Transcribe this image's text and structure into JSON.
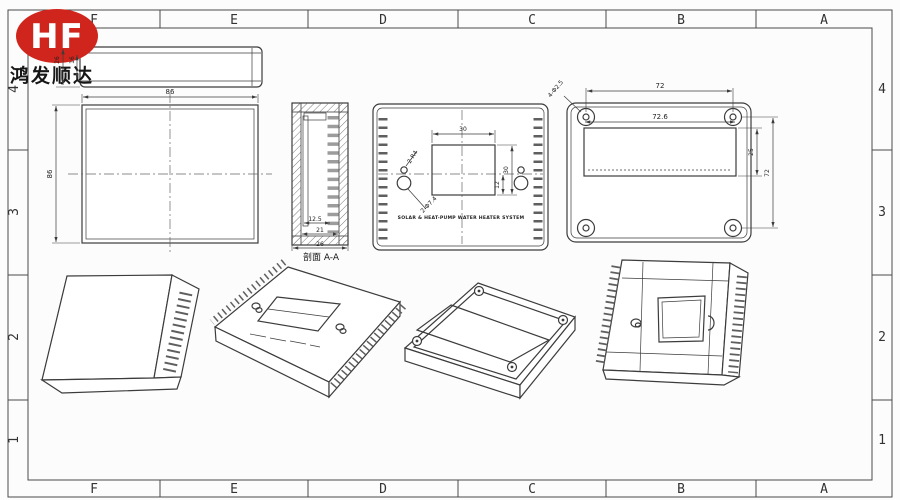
{
  "brand": {
    "logo_text": "HF",
    "company_name": "鸿发顺达"
  },
  "colors": {
    "logo_red": "#d0251c",
    "line": "#3c3c3c"
  },
  "sheet": {
    "columns": [
      "F",
      "E",
      "D",
      "C",
      "B",
      "A"
    ],
    "rows": [
      "4",
      "3",
      "2",
      "1"
    ]
  },
  "views": {
    "top": {
      "dim_total_height": "26",
      "dim_inner_height": "16"
    },
    "front": {
      "dim_width": "86",
      "dim_height": "86"
    },
    "section": {
      "dim_rib": "12.5",
      "dim_inner": "21",
      "dim_depth": "26",
      "label": "剖面 A-A"
    },
    "panel": {
      "dim_window_width": "30",
      "dim_window_height": "30",
      "dim_center_offset": "12",
      "hole_radius_label": "2-R4",
      "hole_dia_label": "2-Φ7.4",
      "caption": "SOLAR & HEAT-PUMP WATER HEATER SYSTEM"
    },
    "back": {
      "dim_hole_span": "72",
      "dim_opening_width": "72.6",
      "dim_opening_height": "25",
      "dim_height": "72",
      "hole_label": "4-Φ2.5"
    }
  }
}
